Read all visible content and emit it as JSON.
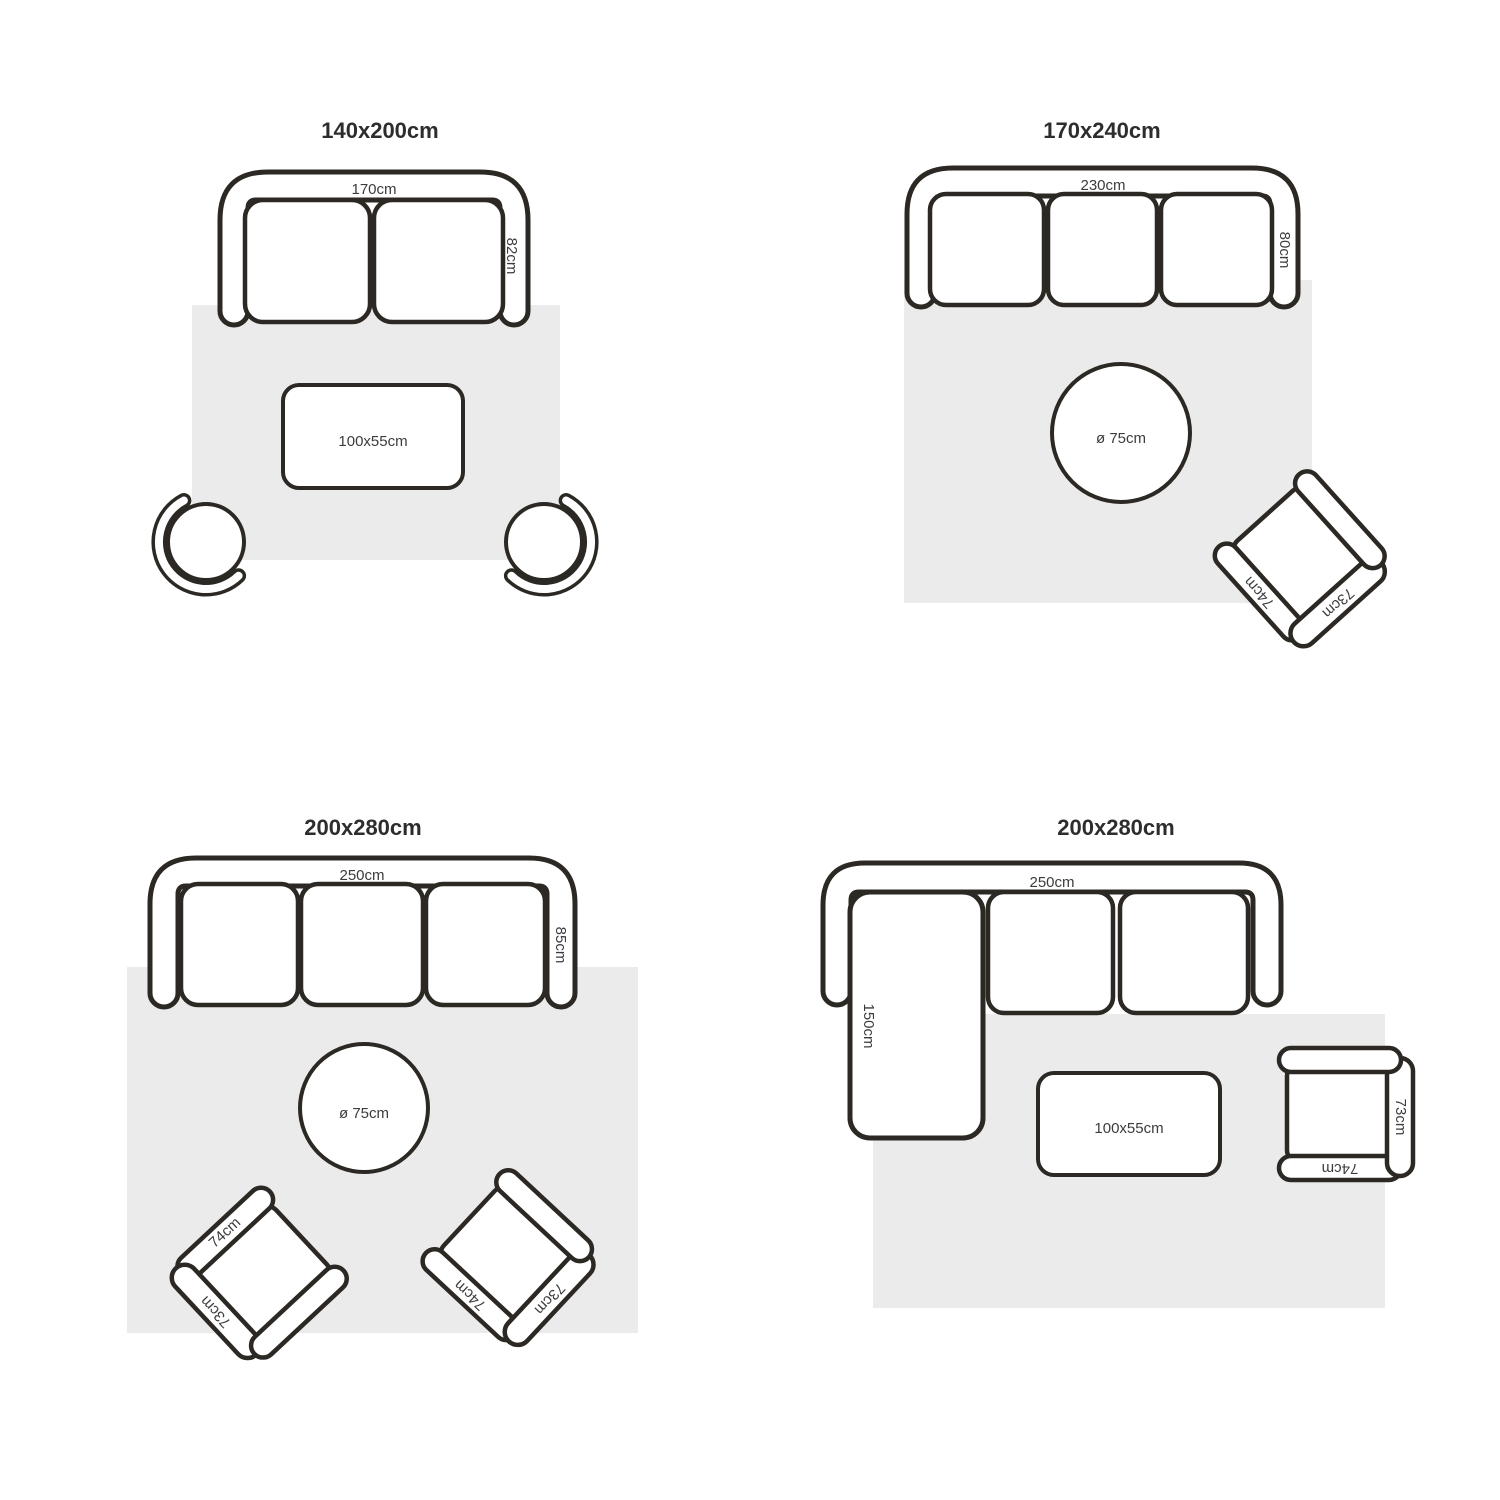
{
  "colors": {
    "outline": "#2c2824",
    "rug": "#ebebeb",
    "label": "#3c3c3c",
    "title": "#2d2d2d",
    "background": "#ffffff"
  },
  "panels": [
    {
      "title": "140x200cm",
      "sofa_width": "170cm",
      "sofa_depth": "82cm",
      "coffee_table": "100x55cm"
    },
    {
      "title": "170x240cm",
      "sofa_width": "230cm",
      "sofa_depth": "80cm",
      "round_table": "ø 75cm"
    },
    {
      "title": "200x280cm",
      "sofa_width": "250cm",
      "sofa_depth": "85cm",
      "round_table": "ø 75cm"
    },
    {
      "title": "200x280cm",
      "sofa_width": "250cm",
      "chaise_length": "150cm",
      "coffee_table": "100x55cm"
    }
  ],
  "armchair": {
    "side": "73cm",
    "front": "74cm"
  }
}
